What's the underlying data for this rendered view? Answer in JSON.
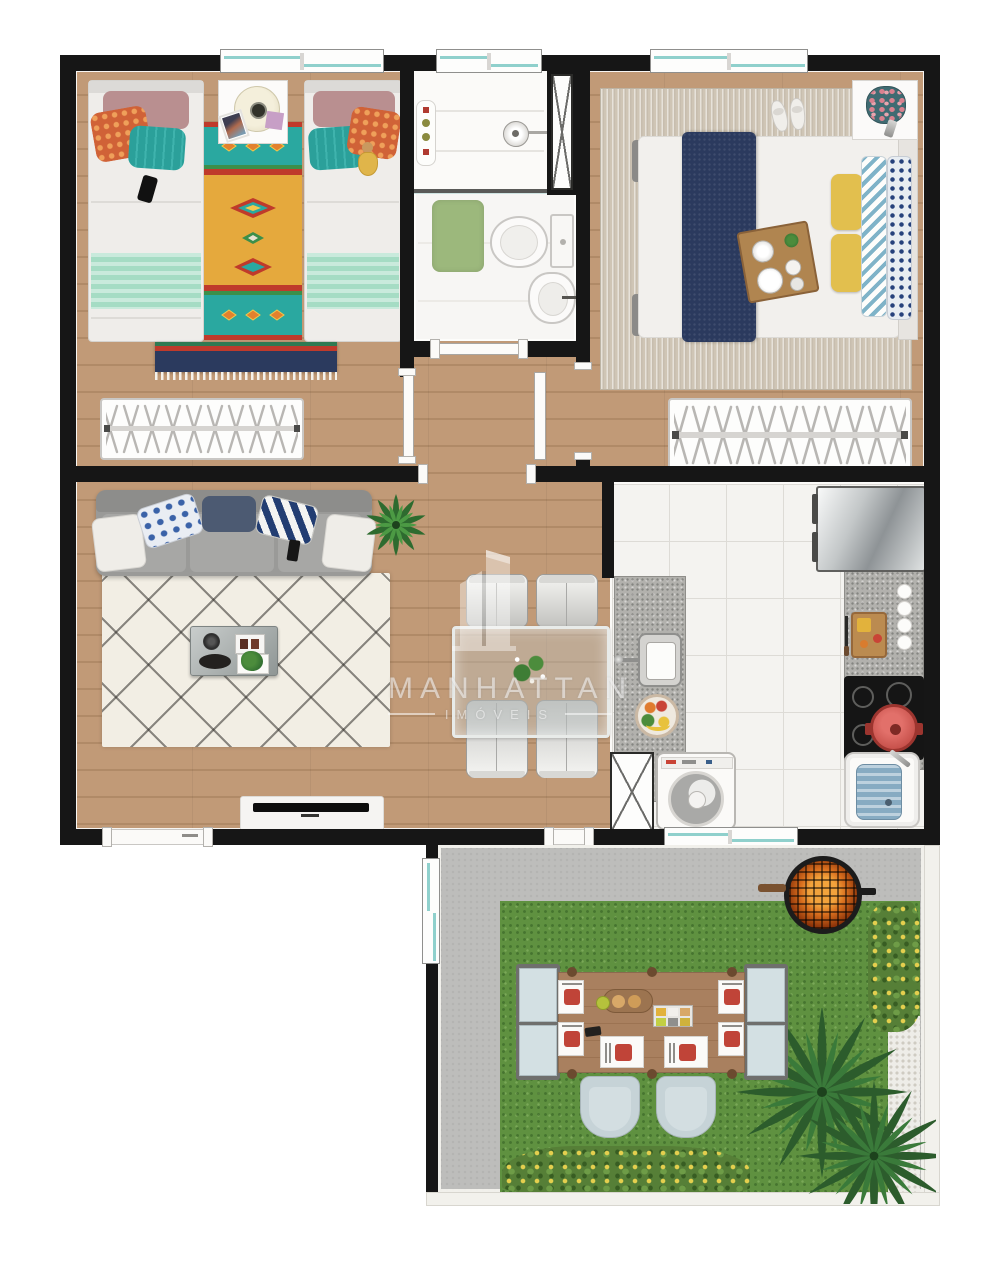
{
  "watermark": {
    "brand": "MANHATTAN",
    "subtitle": "IMÓVEIS"
  },
  "colors": {
    "wall": "#161616",
    "wood": "#c19a77",
    "wood-dark": "#b08a67",
    "tile": "#f4f3f0",
    "grout": "#dddbd6",
    "granite": "#b2b1ad",
    "grass": "#5f9140",
    "patio": "#bdbdbb",
    "gravel": "#eeede8",
    "fence": "#f2f1ec",
    "rug-cream": "#f2eee4",
    "teal": "#2aa8a0",
    "rug-yellow": "#e5a93d",
    "red": "#bf3a2b",
    "navy": "#2b3a5e",
    "mint": "#a5dcc4",
    "sofa": "#9a9a98",
    "glass": "#8fd0cc",
    "fire": "#d96f1e",
    "palm": "#2c5c2c",
    "water": "#87abc2",
    "mat": "#9cb87c",
    "bench": "#d3e0e3",
    "plate": "#c04438",
    "pillow-yellow": "#e2bf4e"
  }
}
